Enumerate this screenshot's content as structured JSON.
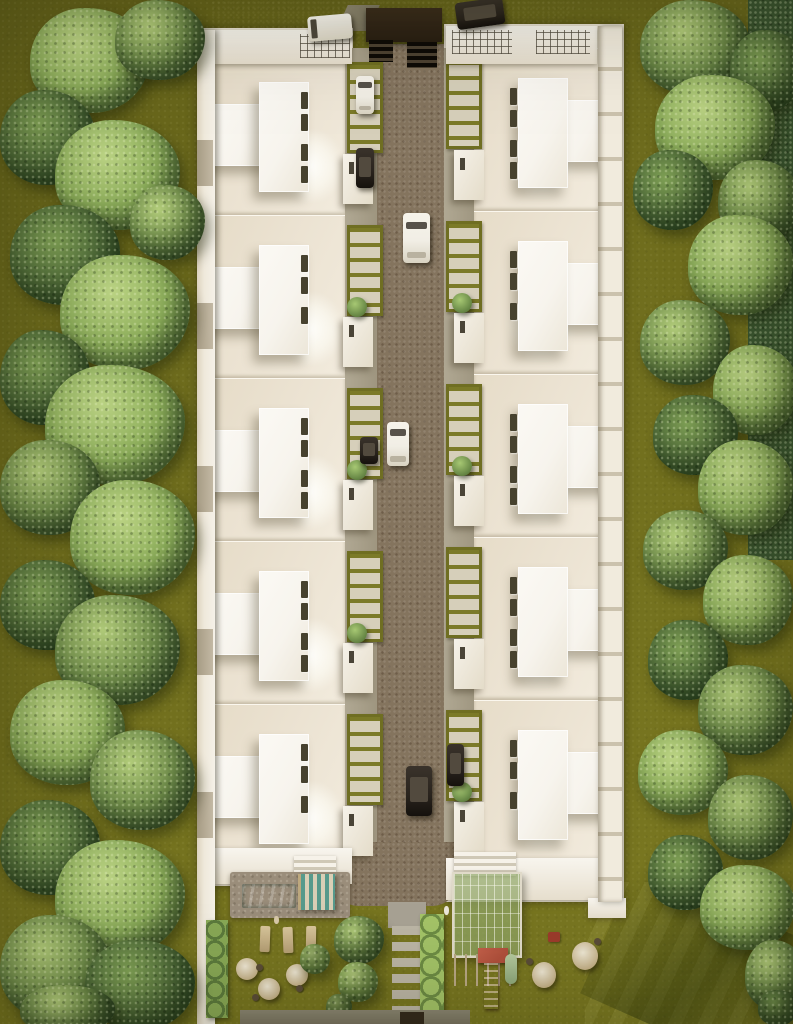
{
  "meta": {
    "description": "Top-down aerial 3D architectural rendering of a gated residential townhouse community: two parallel rows of white flat-roofed townhouses along a central brick driveway, bordered by dense tree bands, with a pool and playground amenity garden at the south end and a dark asphalt parking strip with an entry gate at the north end.",
    "view": "top-down aerial",
    "no_visible_text": true
  },
  "colors": {
    "grass": "#6e6c1d",
    "lawn_bright": "#7a9120",
    "tree_light": "#b2cc7a",
    "tree_mid": "#6f8c4a",
    "tree_dark": "#3a5530",
    "roof_cream": "#ebe2d1",
    "roof_white": "#f7f4ed",
    "wall_light": "#efe9db",
    "road_brick": "#84745e",
    "parking_asphalt": "#4b3c2d",
    "pool_teal": "#58b0a0",
    "deck_stone": "#9a8d7a",
    "furniture_tan": "#c6b086",
    "pergola_green": "#90a868",
    "slide_red": "#b1503c",
    "gate_dark": "#281e12",
    "path_gray": "#a8a294",
    "shadow_tan": "#c4b9a2",
    "car_white": "#f1eee5",
    "car_dark": "#29231d",
    "planter_olive": "#7b7a28",
    "planter_cell": "#d6cfba"
  },
  "inventory": {
    "buildings": {
      "townhouse_rows": 2,
      "units_per_row": 5,
      "features": [
        "flat-roof-terrace",
        "raised-roof-block",
        "skylight-slits",
        "entry-porch",
        "planter-grid",
        "perimeter-wall",
        "roof-railings",
        "stair-runs"
      ]
    },
    "circulation": [
      "central-brick-road",
      "entry-gate-canopy",
      "gate-grates",
      "north-parking-apron",
      "turning-apron",
      "stepping-stone-path",
      "perimeter-path"
    ],
    "vehicles": [
      "white-van-parking",
      "dark-suv-parking",
      "white-sedan-road-upper",
      "white-sedan-road-middle",
      "dark-suv-road-lower",
      "parked-car-left-upper",
      "parked-car-left-middle",
      "parked-car-right-lower"
    ],
    "amenities": [
      "swimming-pool",
      "pool-deck",
      "striped-cabana",
      "sun-loungers-x3",
      "parasol-seating-x3",
      "pergola-canopy",
      "playground-slide",
      "round-tables-x2",
      "barbecue"
    ],
    "vegetation": [
      "left-tree-band",
      "right-tree-band",
      "courtyard-trees",
      "hedge-column",
      "bush-row",
      "bright-lawn-southeast"
    ]
  }
}
